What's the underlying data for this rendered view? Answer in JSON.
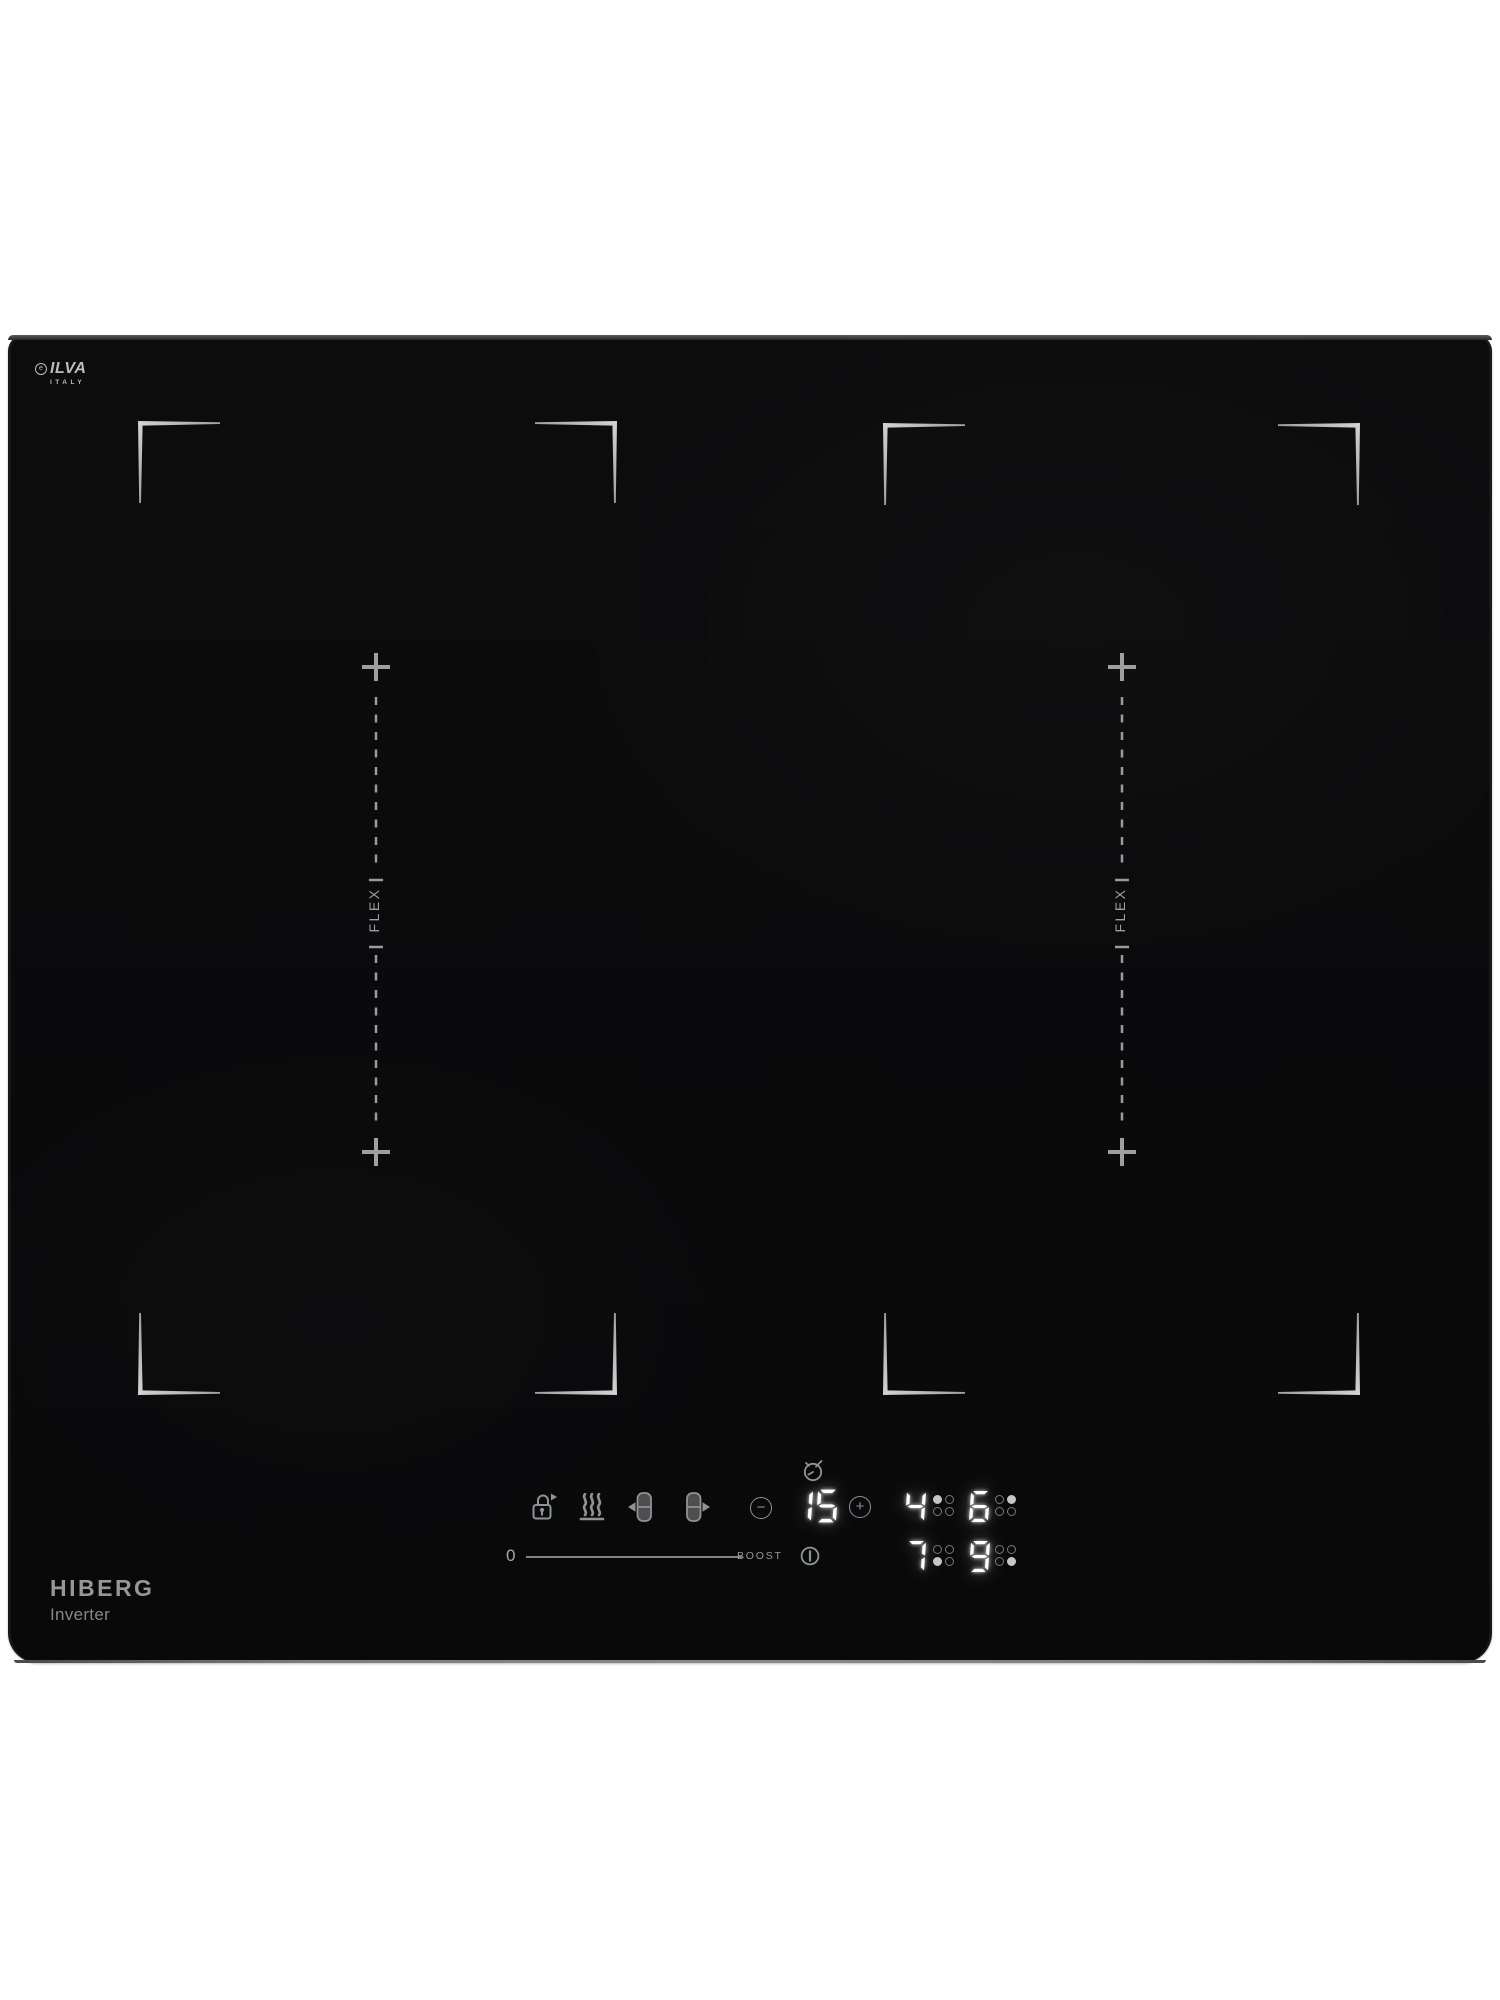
{
  "brand_top": {
    "mark_letter": "e",
    "name": "ILVA",
    "country": "ITALY"
  },
  "brand_bottom": {
    "name": "HIBERG",
    "tagline": "Inverter"
  },
  "cooking_surface": {
    "flex_zone_left_label": "FLEX",
    "flex_zone_right_label": "FLEX"
  },
  "control_panel": {
    "icons": {
      "lock": "lock-with-arrow-icon",
      "residual_heat": "keep-warm-icon",
      "bridge_left": "flex-bridge-left-icon",
      "bridge_right": "flex-bridge-right-icon",
      "timer": "timer-clock-icon",
      "power": "power-standby-icon"
    },
    "timer": {
      "value": "15",
      "minus_label": "−",
      "plus_label": "+"
    },
    "power_slider": {
      "min_label": "0",
      "max_label": "BOOST"
    },
    "burner_displays": [
      {
        "zone": "rear-left",
        "power_level": "4",
        "indicator_dot": "top-left"
      },
      {
        "zone": "rear-right",
        "power_level": "6",
        "indicator_dot": "top-right"
      },
      {
        "zone": "front-left",
        "power_level": "7",
        "indicator_dot": "bottom-left"
      },
      {
        "zone": "front-right",
        "power_level": "9",
        "indicator_dot": "bottom-right"
      }
    ]
  },
  "colors": {
    "glass": "#0a0a0b",
    "display_white": "#ffffff",
    "icon_gray": "#8f9296",
    "marking_gray": "#a8a8a8",
    "background": "#ffffff"
  }
}
